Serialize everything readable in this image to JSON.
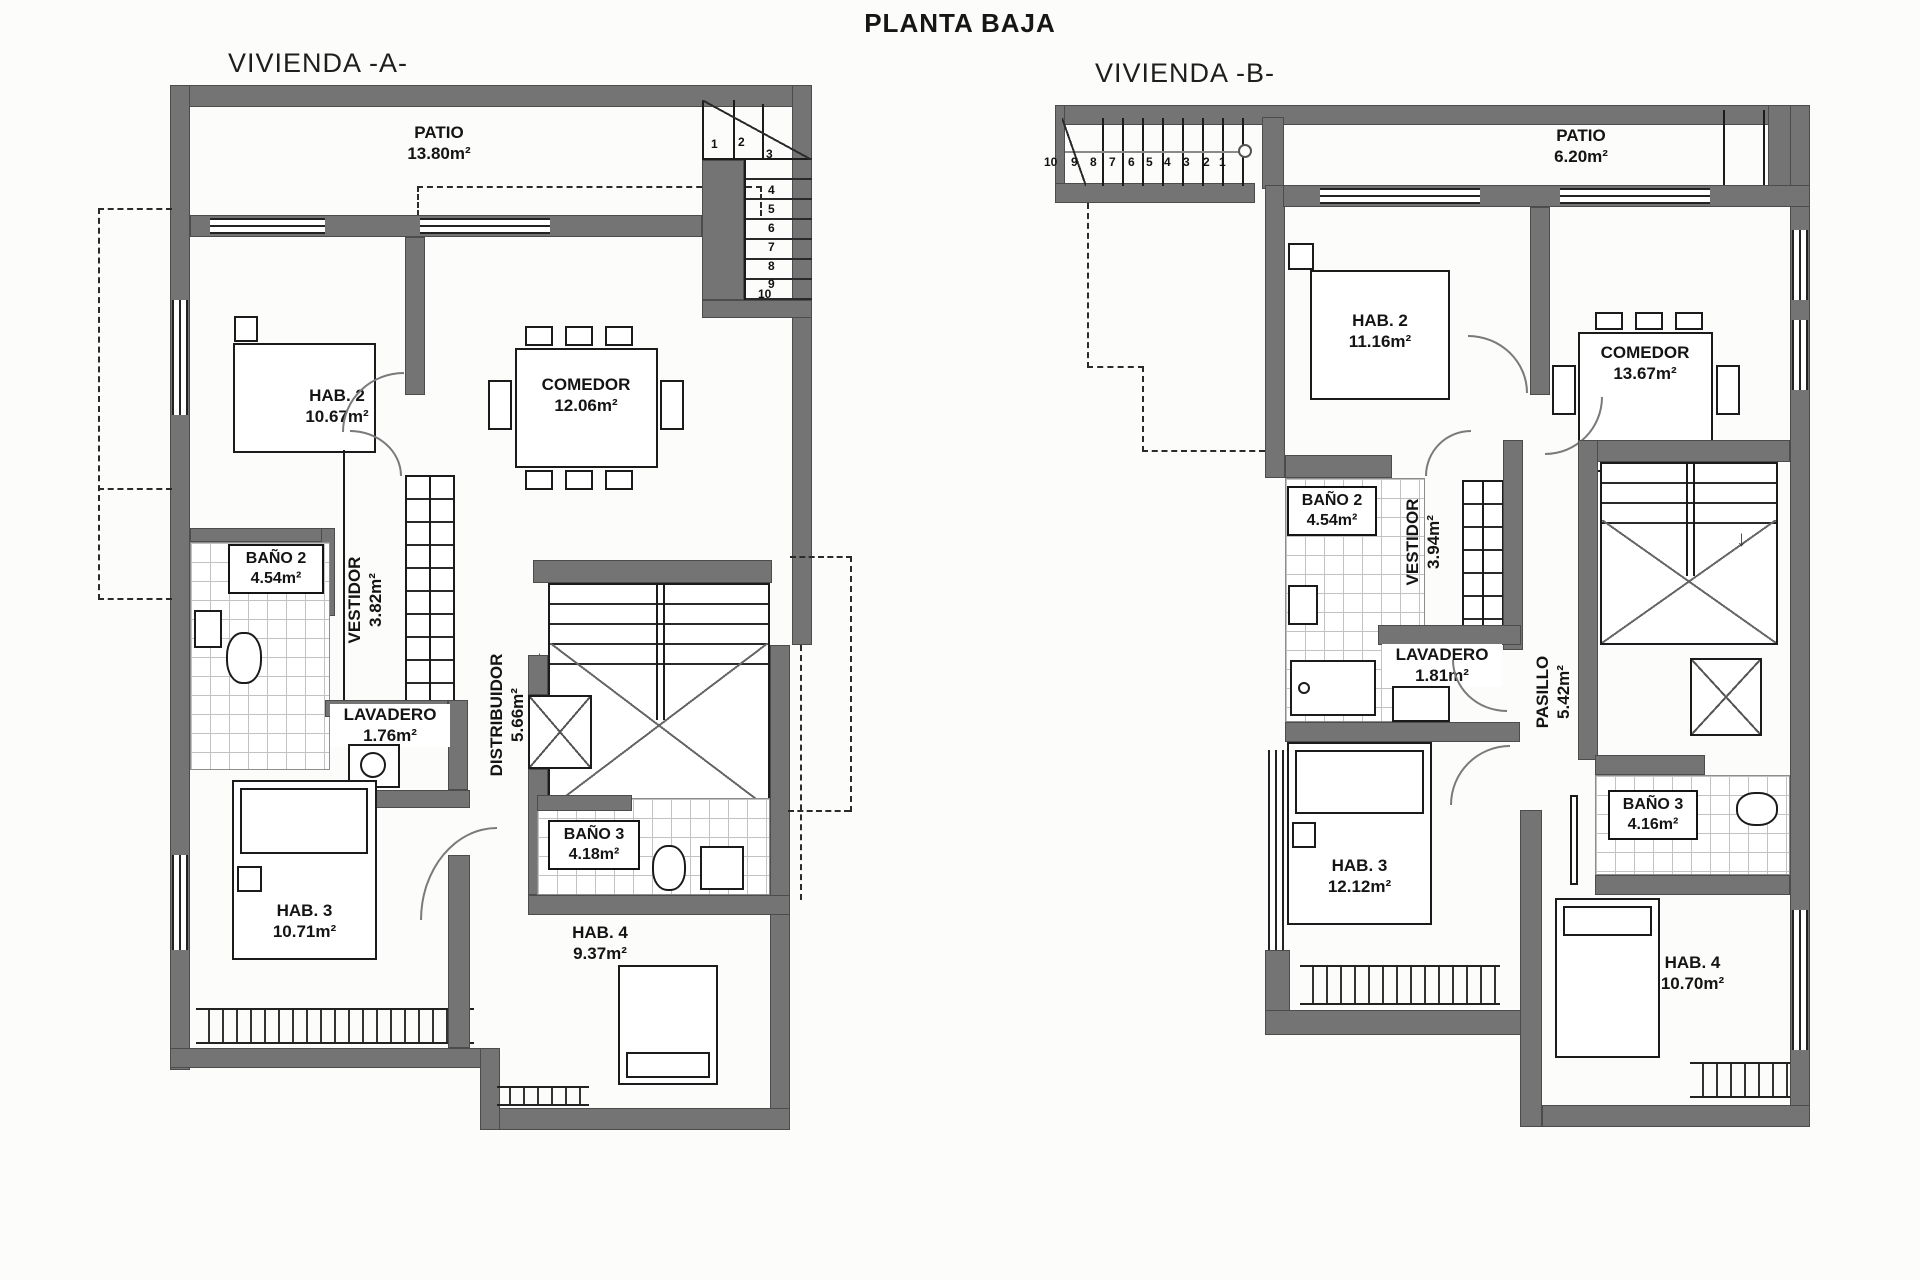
{
  "page": {
    "title": "PLANTA BAJA"
  },
  "plans": [
    {
      "name": "VIVIENDA -A-",
      "rooms": {
        "patio": {
          "label": "PATIO",
          "area": "13.80m²"
        },
        "hab2": {
          "label": "HAB. 2",
          "area": "10.67m²"
        },
        "comedor": {
          "label": "COMEDOR",
          "area": "12.06m²"
        },
        "bano2": {
          "label": "BAÑO 2",
          "area": "4.54m²"
        },
        "vestidor": {
          "label": "VESTIDOR",
          "area": "3.82m²"
        },
        "lavadero": {
          "label": "LAVADERO",
          "area": "1.76m²"
        },
        "distribuidor": {
          "label": "DISTRIBUIDOR",
          "area": "5.66m²"
        },
        "bano3": {
          "label": "BAÑO 3",
          "area": "4.18m²"
        },
        "hab3": {
          "label": "HAB. 3",
          "area": "10.71m²"
        },
        "hab4": {
          "label": "HAB. 4",
          "area": "9.37m²"
        }
      },
      "stair_numbers": [
        "1",
        "2",
        "3",
        "4",
        "5",
        "6",
        "7",
        "8",
        "9",
        "10"
      ]
    },
    {
      "name": "VIVIENDA -B-",
      "rooms": {
        "patio": {
          "label": "PATIO",
          "area": "6.20m²"
        },
        "hab2": {
          "label": "HAB. 2",
          "area": "11.16m²"
        },
        "comedor": {
          "label": "COMEDOR",
          "area": "13.67m²"
        },
        "bano2": {
          "label": "BAÑO 2",
          "area": "4.54m²"
        },
        "vestidor": {
          "label": "VESTIDOR",
          "area": "3.94m²"
        },
        "lavadero": {
          "label": "LAVADERO",
          "area": "1.81m²"
        },
        "pasillo": {
          "label": "PASILLO",
          "area": "5.42m²"
        },
        "bano3": {
          "label": "BAÑO 3",
          "area": "4.16m²"
        },
        "hab3": {
          "label": "HAB. 3",
          "area": "12.12m²"
        },
        "hab4": {
          "label": "HAB. 4",
          "area": "10.70m²"
        }
      },
      "stair_numbers": [
        "10",
        "9",
        "8",
        "7",
        "6",
        "5",
        "4",
        "3",
        "2",
        "1"
      ]
    }
  ],
  "colors": {
    "wall": "#747474",
    "line": "#1b1b1b",
    "tile_line": "#c2c2c2"
  }
}
